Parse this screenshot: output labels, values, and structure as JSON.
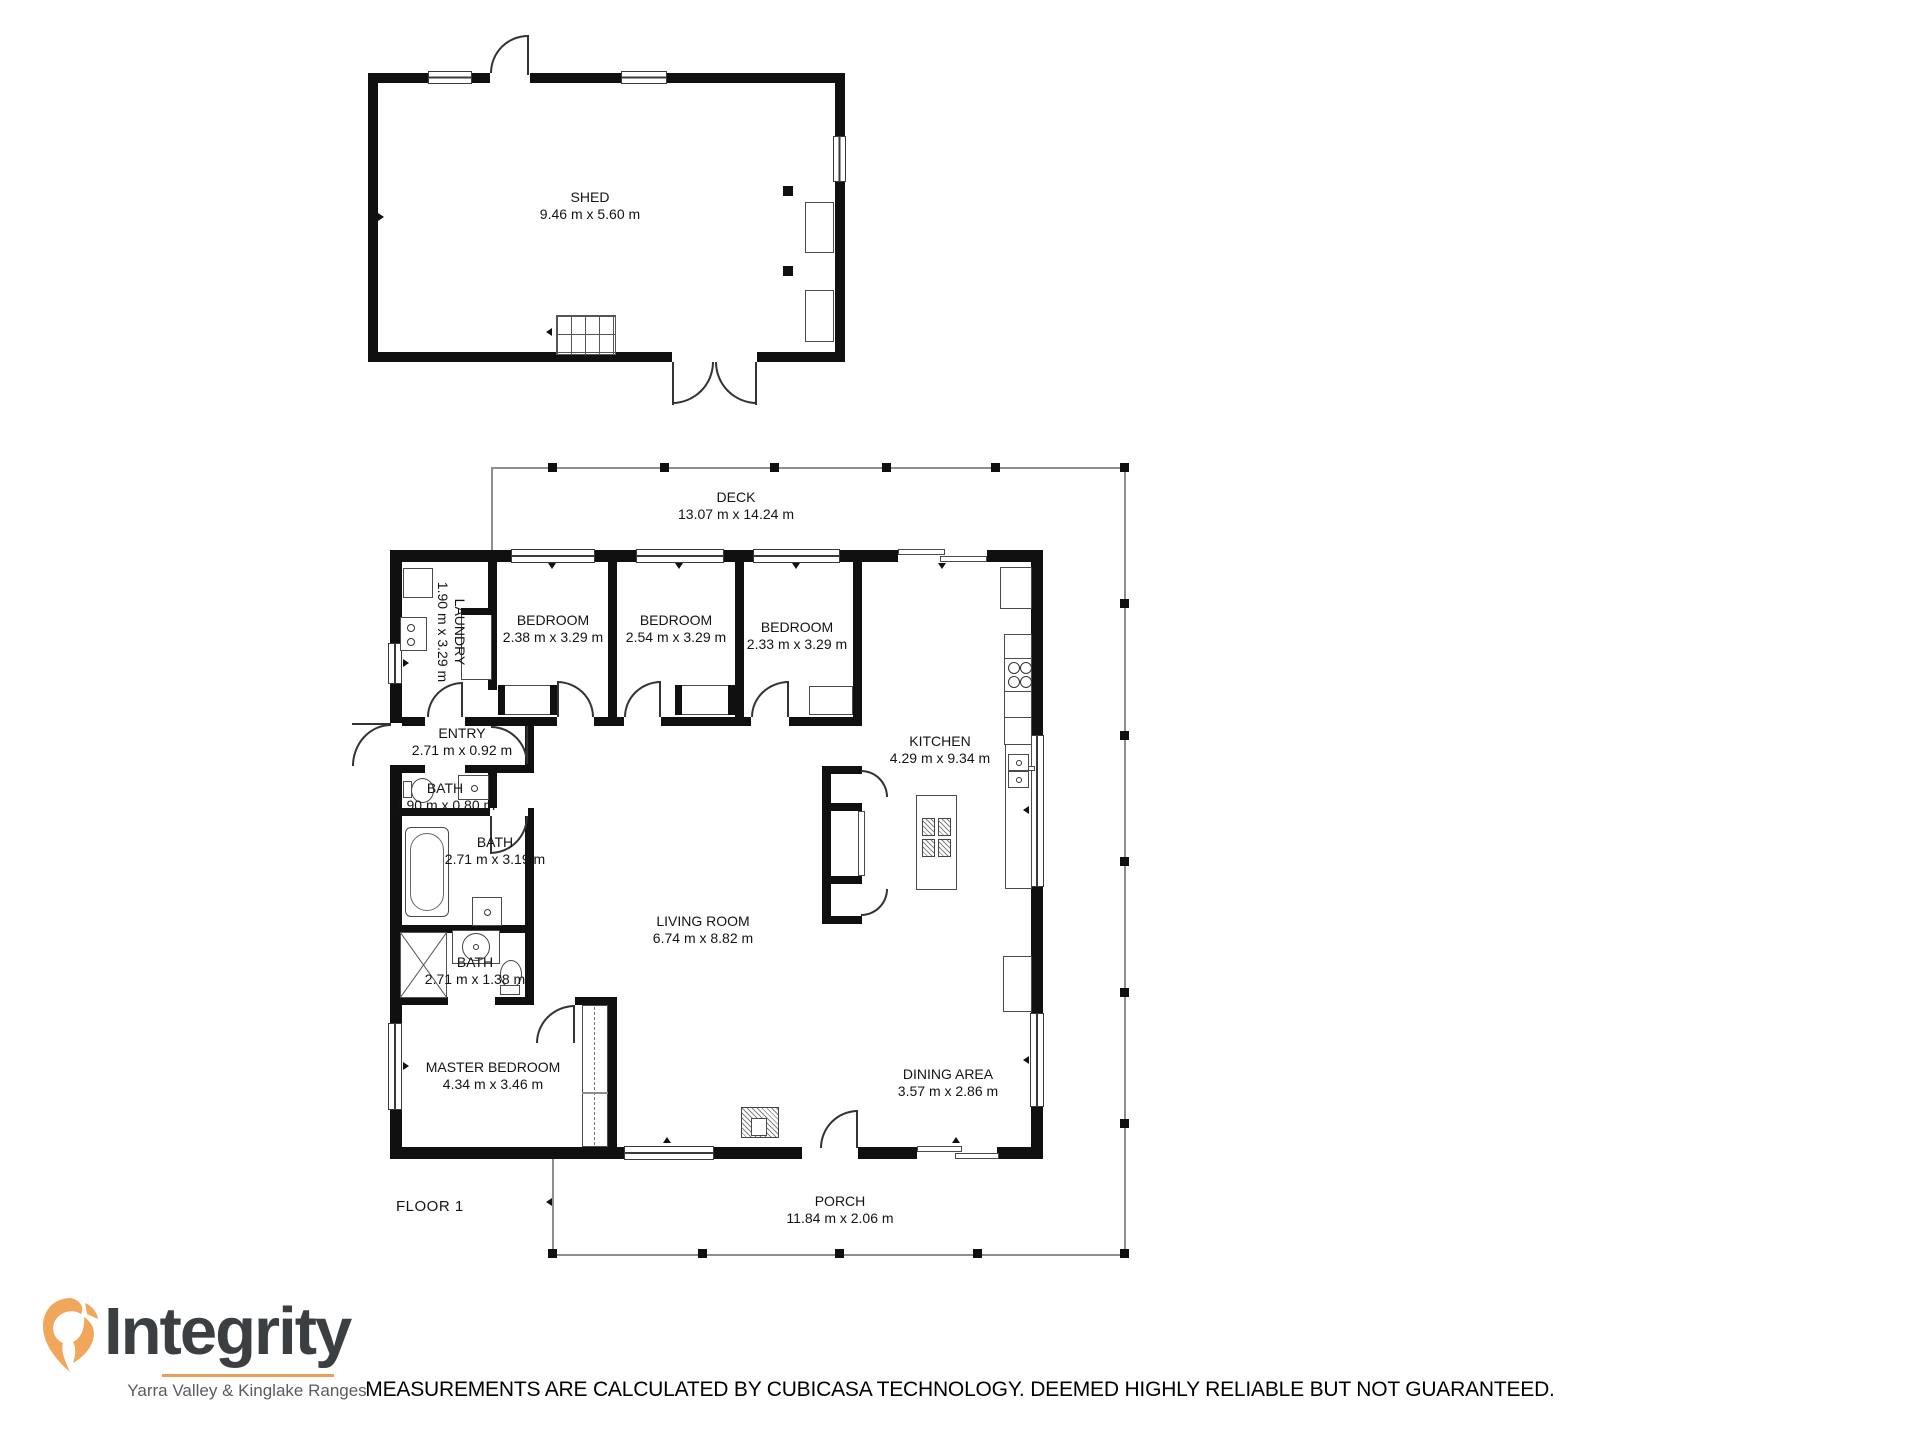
{
  "branding": {
    "name": "Integrity",
    "tagline": "Yarra Valley & Kinglake Ranges",
    "accent_orange": "#E8A153",
    "logo_text_color": "#3B3F42"
  },
  "disclaimer": "MEASUREMENTS ARE CALCULATED BY CUBICASA TECHNOLOGY. DEEMED HIGHLY RELIABLE BUT NOT GUARANTEED.",
  "floor_label": "FLOOR 1",
  "rooms": {
    "shed": {
      "name": "SHED",
      "dims": "9.46 m x 5.60 m"
    },
    "deck": {
      "name": "DECK",
      "dims": "13.07 m x 14.24 m"
    },
    "laundry": {
      "name": "LAUNDRY",
      "dims": "1.90 m x 3.29 m"
    },
    "bedroom1": {
      "name": "BEDROOM",
      "dims": "2.38 m x 3.29 m"
    },
    "bedroom2": {
      "name": "BEDROOM",
      "dims": "2.54 m x 3.29 m"
    },
    "bedroom3": {
      "name": "BEDROOM",
      "dims": "2.33 m x 3.29 m"
    },
    "entry": {
      "name": "ENTRY",
      "dims": "2.71 m x 0.92 m"
    },
    "bath_small": {
      "name": "BATH",
      "dims": "1.90 m x 0.80 m"
    },
    "bath_main": {
      "name": "BATH",
      "dims": "2.71 m x 3.19 m"
    },
    "bath_ensuite": {
      "name": "BATH",
      "dims": "2.71 m x 1.38 m"
    },
    "kitchen": {
      "name": "KITCHEN",
      "dims": "4.29 m x 9.34 m"
    },
    "living": {
      "name": "LIVING ROOM",
      "dims": "6.74 m x 8.82 m"
    },
    "master": {
      "name": "MASTER BEDROOM",
      "dims": "4.34 m x 3.46 m"
    },
    "dining": {
      "name": "DINING AREA",
      "dims": "3.57 m x 2.86 m"
    },
    "porch": {
      "name": "PORCH",
      "dims": "11.84 m x 2.06 m"
    }
  }
}
